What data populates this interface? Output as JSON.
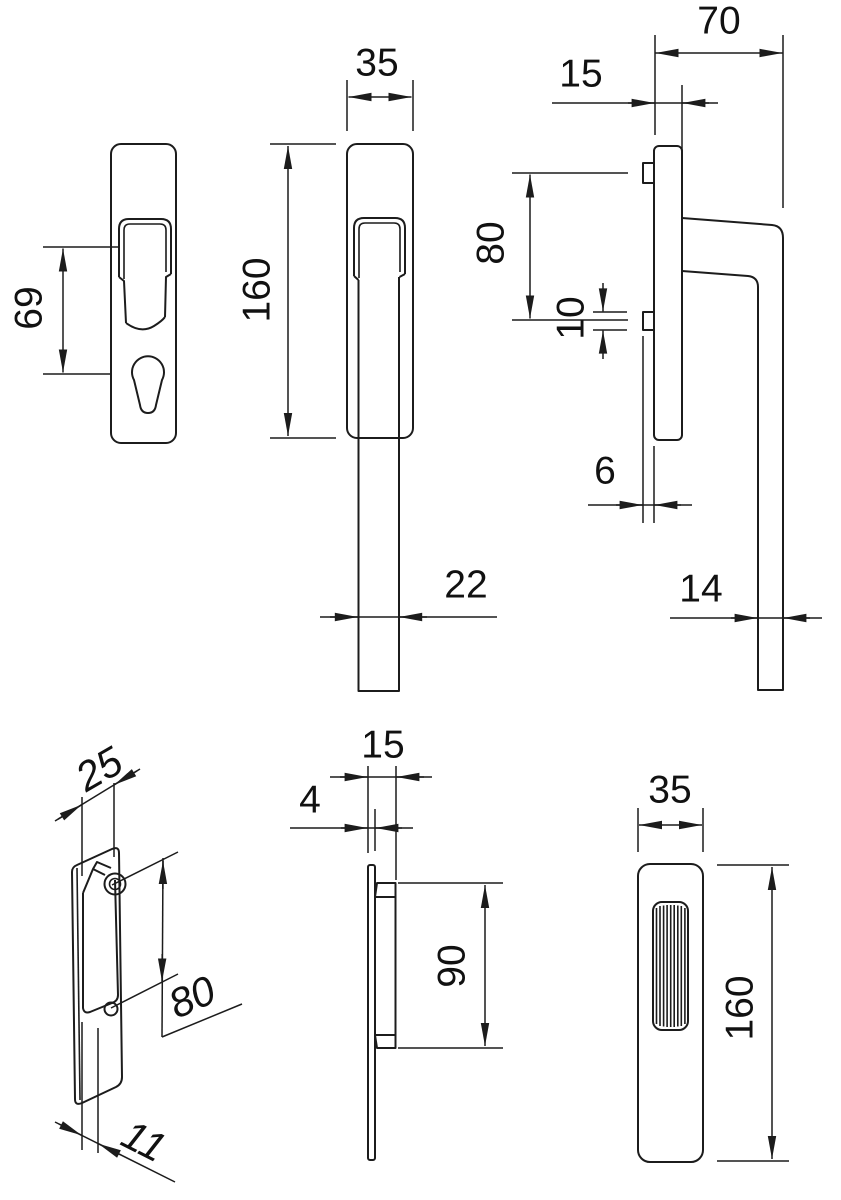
{
  "drawing": {
    "kind": "technical dimension drawing",
    "subject": "lift-slide door handle set, six orthographic and oblique views",
    "units_shown": "mm"
  },
  "colors": {
    "line": "#1c1c1c",
    "text": "#111111",
    "background": "#ffffff"
  },
  "views": {
    "backplate_front": {
      "dims": {
        "d69": "69"
      }
    },
    "handle_front": {
      "dims": {
        "d35": "35",
        "d160": "160",
        "d22": "22"
      }
    },
    "handle_side": {
      "dims": {
        "d70": "70",
        "d15": "15",
        "d80": "80",
        "d10": "10",
        "d6": "6",
        "d14": "14"
      }
    },
    "carriage_oblique": {
      "dims": {
        "d25": "25",
        "d80": "80",
        "d11": "11"
      }
    },
    "pull_side": {
      "dims": {
        "d15": "15",
        "d4": "4",
        "d90": "90"
      }
    },
    "pull_front": {
      "dims": {
        "d35": "35",
        "d160": "160"
      }
    }
  }
}
